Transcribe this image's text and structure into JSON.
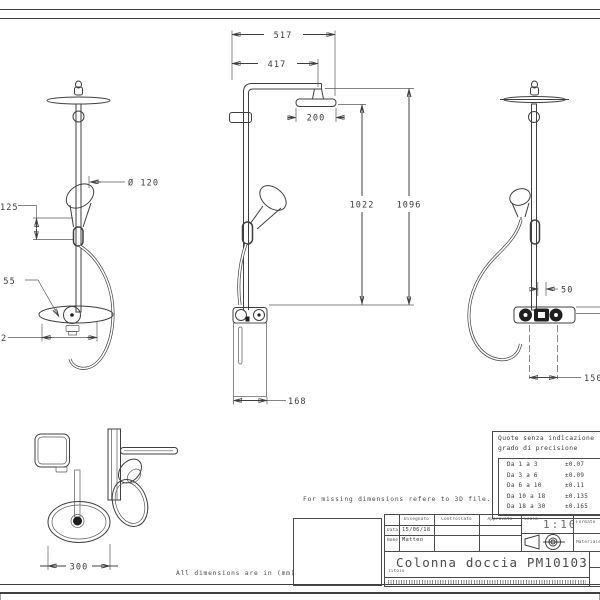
{
  "colors": {
    "line": "#3f3f3f",
    "background": "#ffffff",
    "dark_fill": "#1e1e1e",
    "margin": "#e7e7e7"
  },
  "notes": {
    "missing_dims": "For missing dimensions refere to 3D file.",
    "units": "All dimensions are in (mm)"
  },
  "dimensions": {
    "front": {
      "total_width": "517",
      "arm_width": "417",
      "head_width": "200",
      "hose_height": "1022",
      "total_height": "1096",
      "base_width": "168"
    },
    "left": {
      "hand_shower_dia": "Ø 120",
      "bracket_offset": "125",
      "knob_dia": "Ø 55",
      "base_cut": "2"
    },
    "right": {
      "hose_offset": "50",
      "valve_width": "150"
    },
    "top": {
      "head_dia": "300"
    }
  },
  "tolerance_table": {
    "header_line1": "Quote senza indicazione",
    "header_line2": "grado di precisione",
    "rows": [
      {
        "range": "Da 1 a 3",
        "tol": "±0.07"
      },
      {
        "range": "Da 3 a 6",
        "tol": "±0.09"
      },
      {
        "range": "Da 6 a 10",
        "tol": "±0.11"
      },
      {
        "range": "Da 10 a 18",
        "tol": "±0.135"
      },
      {
        "range": "Da 18 a 30",
        "tol": "±0.165"
      }
    ]
  },
  "title_block": {
    "col_headers": [
      "Disegnato",
      "Controllato",
      "Approvato"
    ],
    "row_labels": [
      "Data",
      "Nome"
    ],
    "date_value": "15/06/18",
    "name_value": "Matteo",
    "scale_label": "Scala",
    "scale_value": "1:10",
    "format_label": "Formato",
    "material_label": "Materiale",
    "title_label": "Titolo",
    "drawing_title": "Colonna doccia PM10103"
  }
}
